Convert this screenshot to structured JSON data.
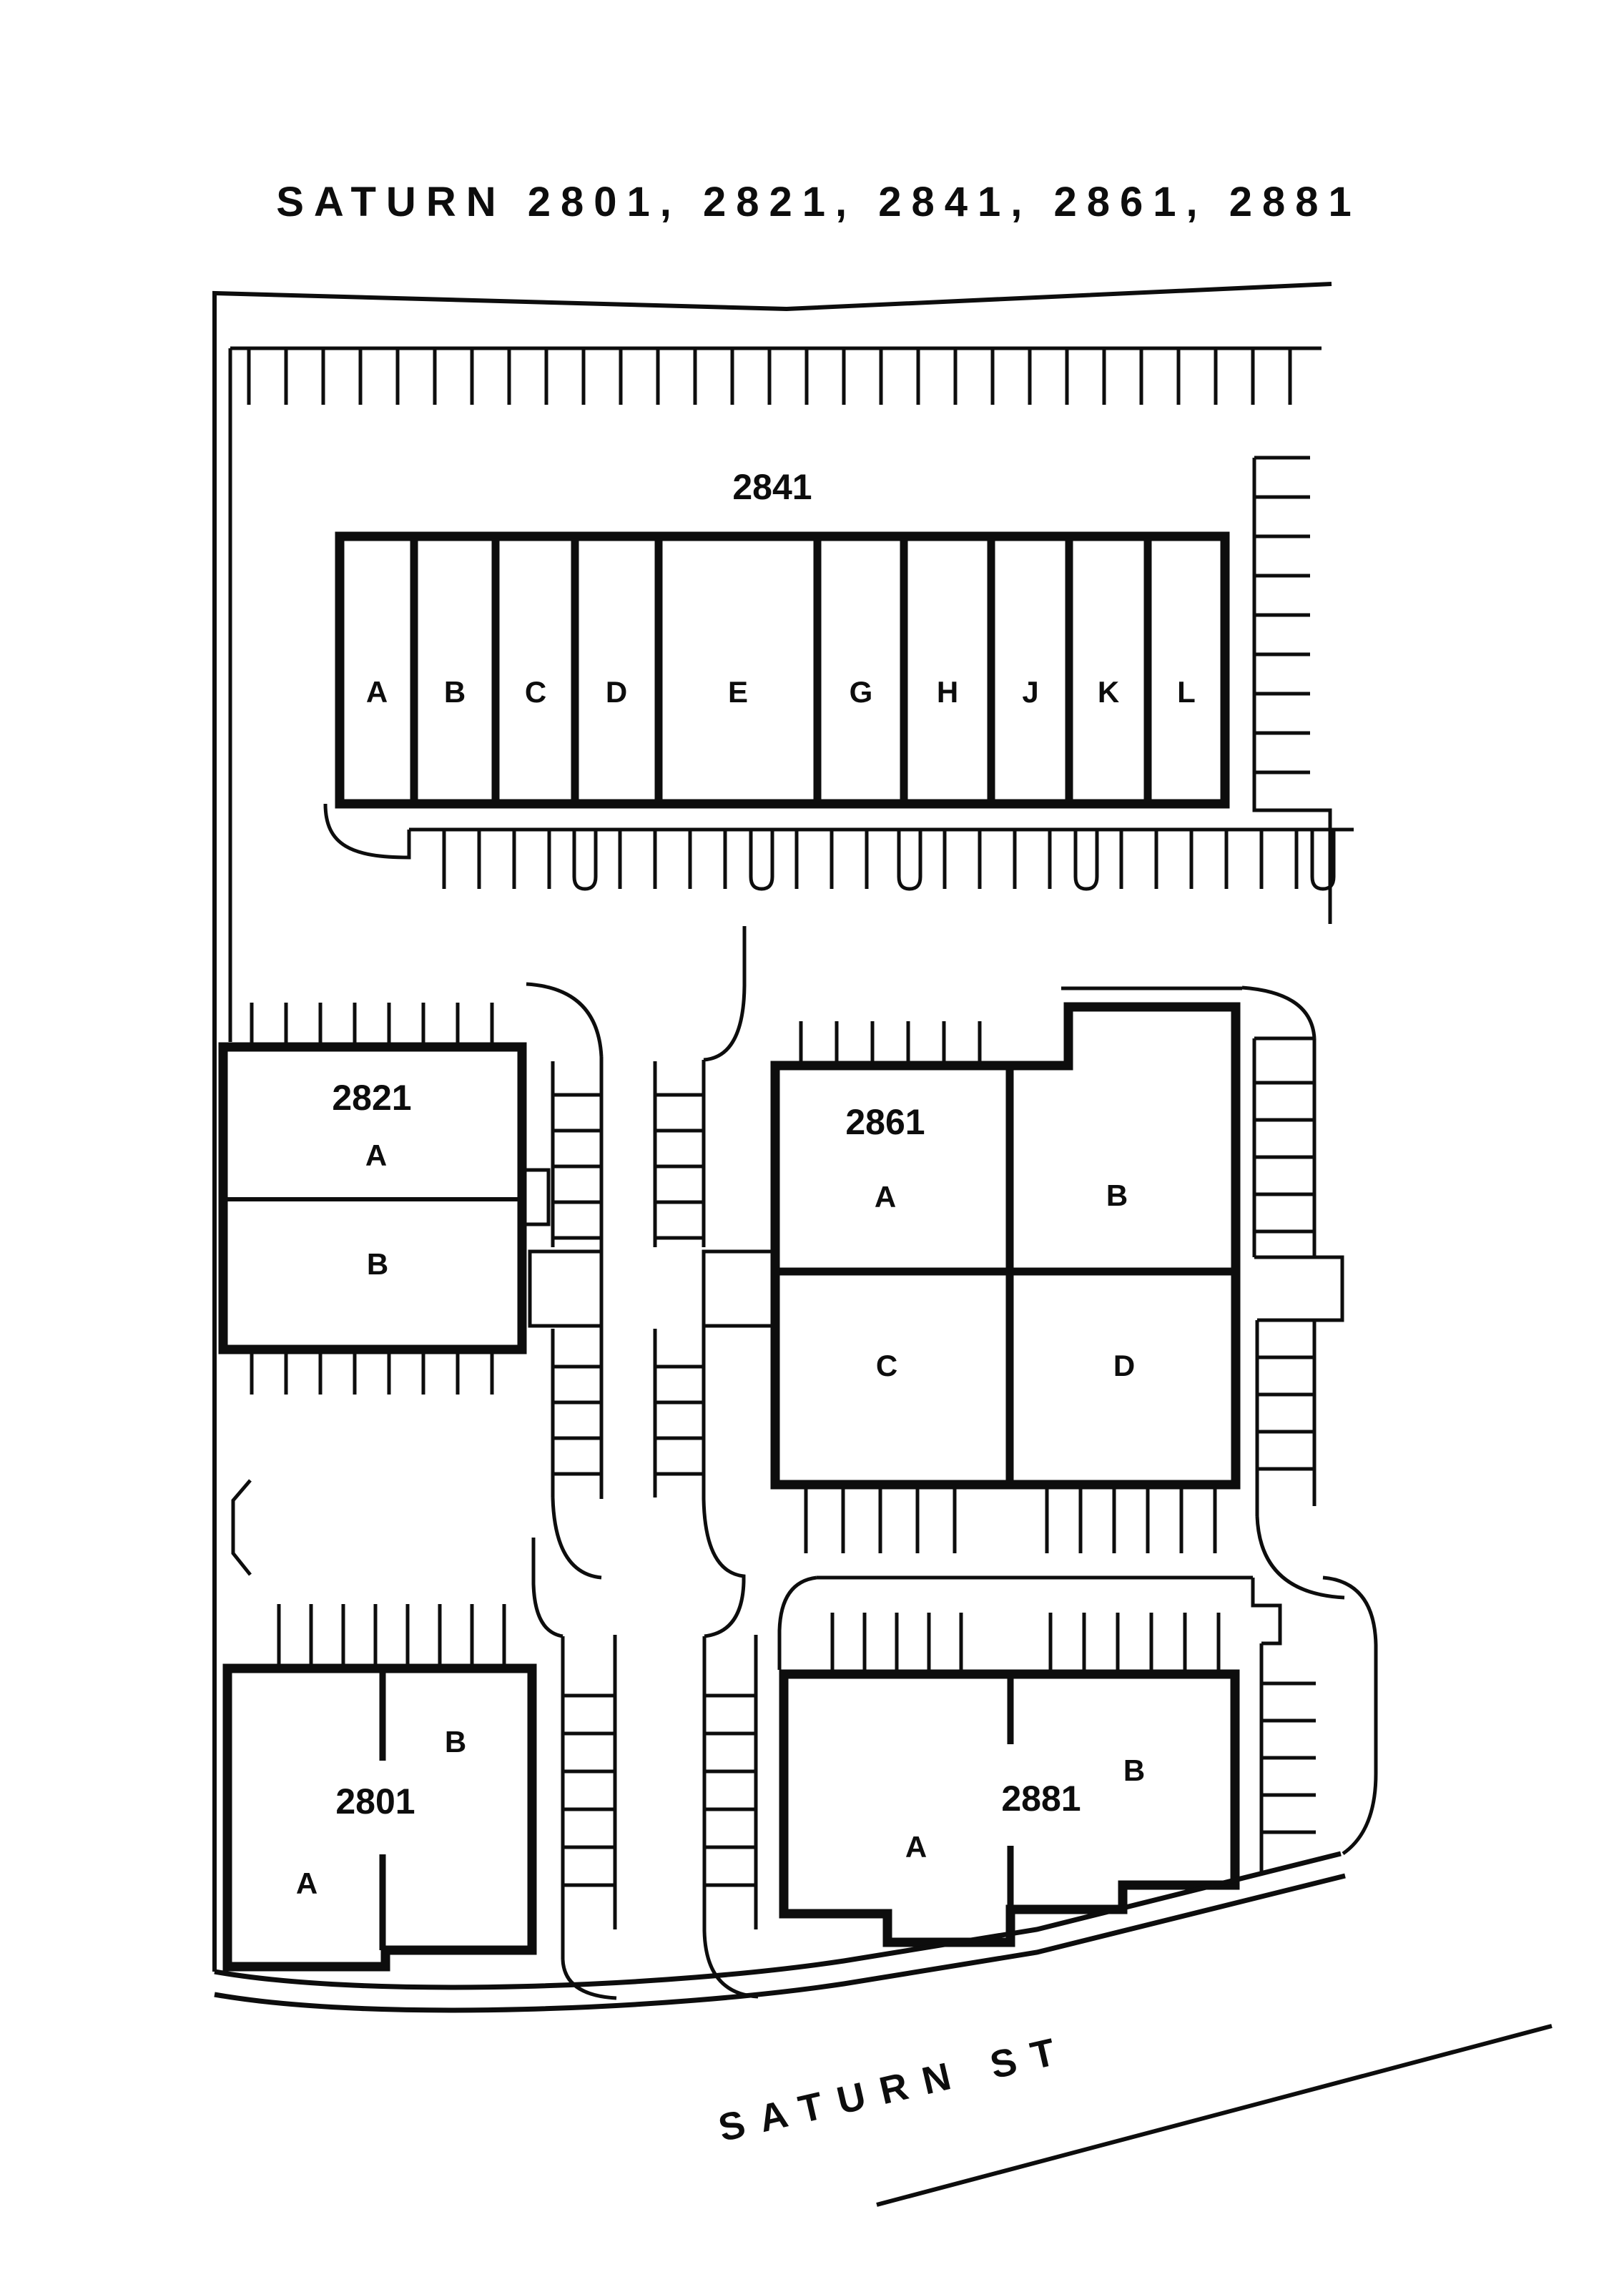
{
  "title": "SATURN 2801, 2821, 2841, 2861, 2881",
  "street": {
    "name": "SATURN ST"
  },
  "buildings": [
    {
      "id": "2841",
      "units": [
        "A",
        "B",
        "C",
        "D",
        "E",
        "G",
        "H",
        "J",
        "K",
        "L"
      ]
    },
    {
      "id": "2821",
      "units": [
        "A",
        "B"
      ]
    },
    {
      "id": "2861",
      "units": [
        "A",
        "B",
        "C",
        "D"
      ]
    },
    {
      "id": "2801",
      "units": [
        "A",
        "B"
      ]
    },
    {
      "id": "2881",
      "units": [
        "A",
        "B"
      ]
    }
  ],
  "colors": {
    "line": "#0d0d0d",
    "background": "#ffffff"
  }
}
